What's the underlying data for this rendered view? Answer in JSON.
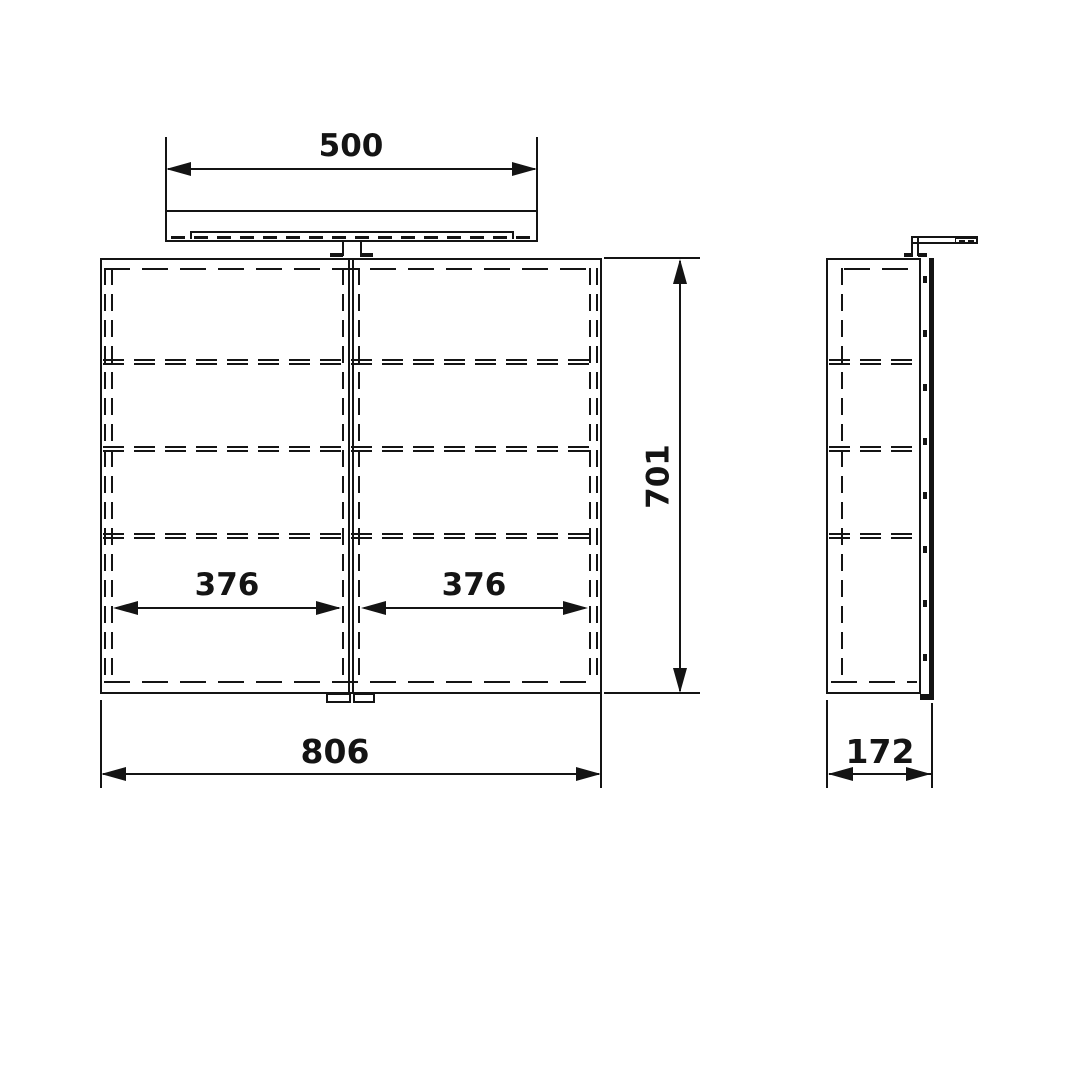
{
  "meta": {
    "background_color": "#ffffff",
    "line_color": "#141414",
    "drawing_type": "mirror cabinet with light - dimensional drawing, front and side views"
  },
  "dimensions": {
    "light_width": "500",
    "cabinet_height": "701",
    "door_left_width": "376",
    "door_right_width": "376",
    "cabinet_width": "806",
    "cabinet_depth": "172"
  }
}
